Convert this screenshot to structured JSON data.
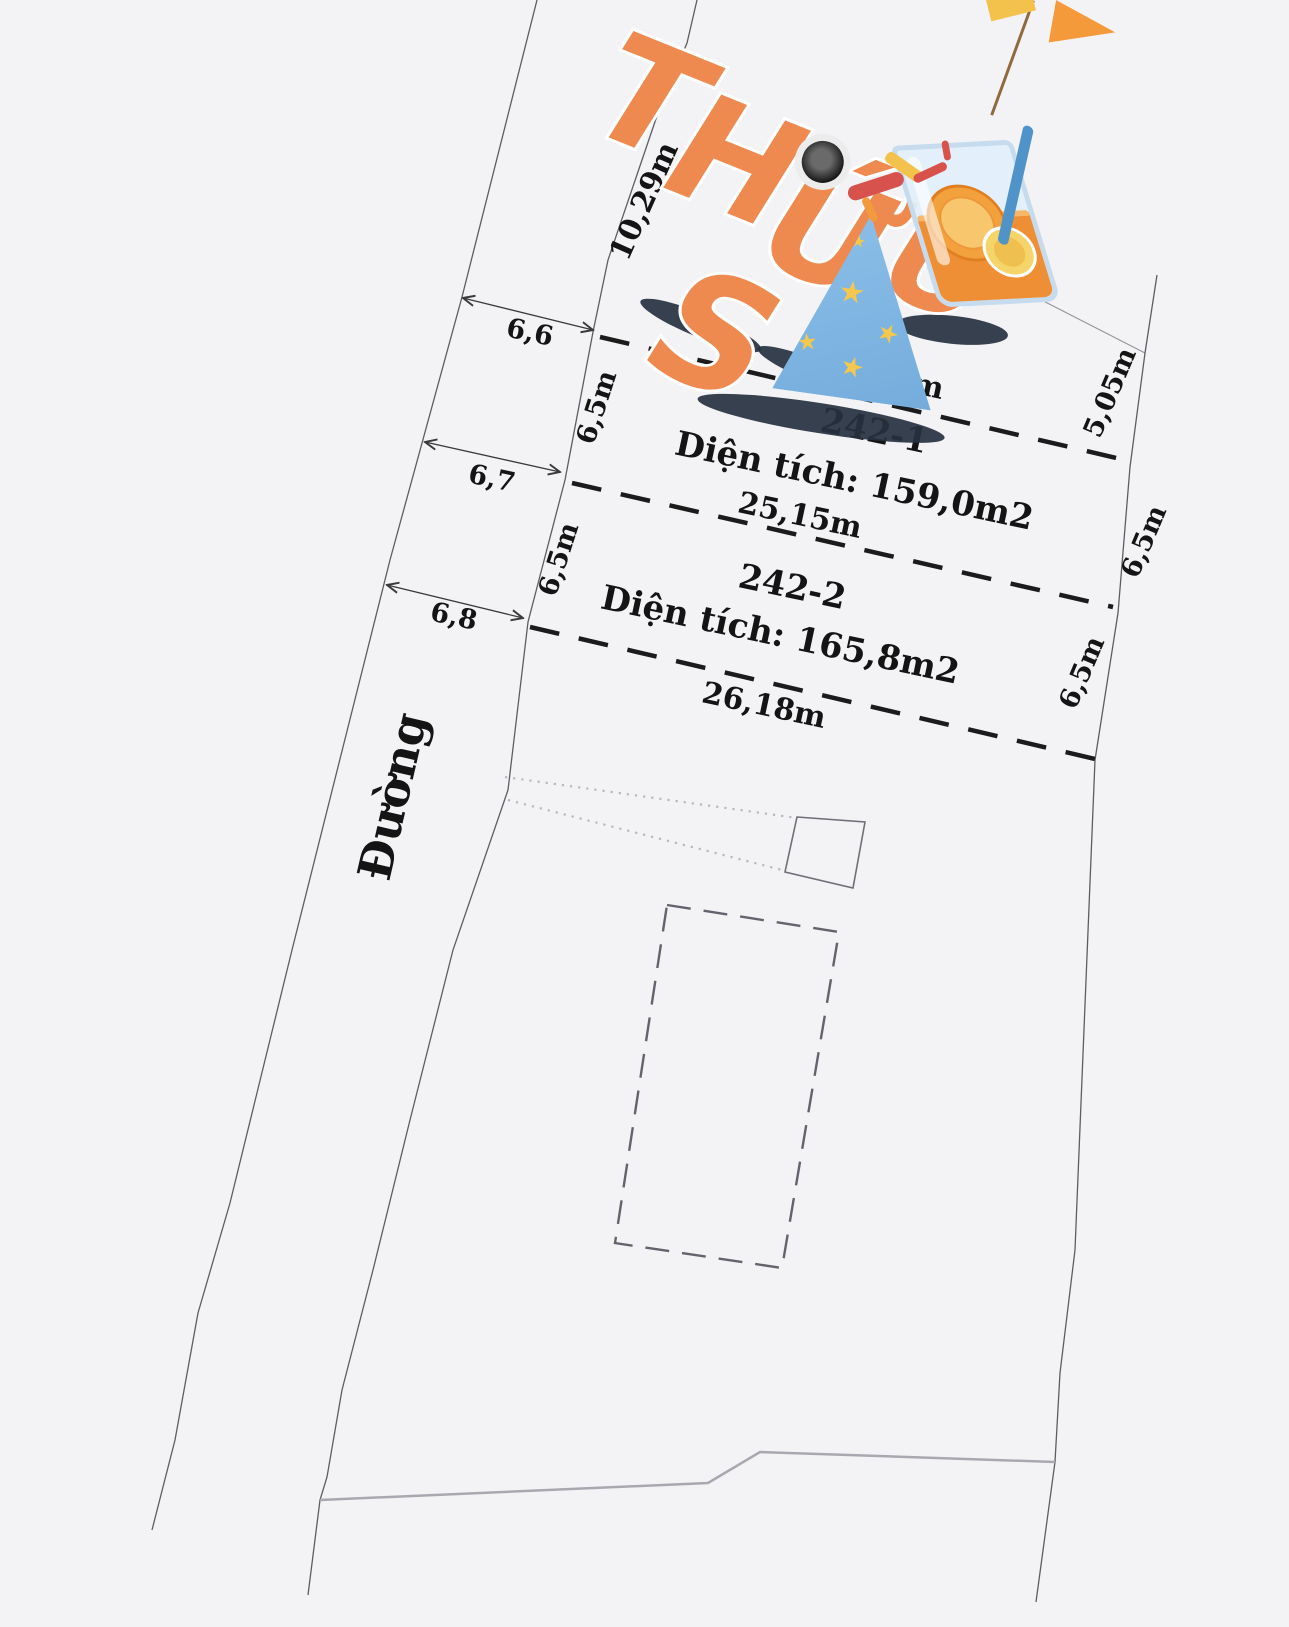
{
  "banner": {
    "letters_top": [
      "T",
      "H",
      "Ứ"
    ],
    "letter_s": "S",
    "letter_u": "U",
    "word_full": "THỨ SÁU"
  },
  "road": {
    "name": "Đường"
  },
  "parcels": [
    {
      "id": "242-1",
      "area": "Diện tích: 159,0m2"
    },
    {
      "id": "242-2",
      "area": "Diện tích: 165,8m2"
    }
  ],
  "dimensions": {
    "top_boundary": "10,29m",
    "road_width_top": "6,6",
    "road_width_mid": "6,7",
    "road_width_bottom": "6,8",
    "west_depth_1": "6,5m",
    "west_depth_2": "6,5m",
    "east_top": "5,05m",
    "east_depth_1": "6,5m",
    "east_depth_2": "6,5m",
    "edge_1": "24,11m",
    "edge_2": "25,15m",
    "edge_3": "26,18m"
  },
  "colors": {
    "background": "#f3f3f6",
    "boundary_line": "#5c5c63",
    "divider_dash": "#1b1b1b",
    "south_boundary_gray": "#a8a8b0",
    "footprint_dash": "#63636d",
    "letter_orange": "#ee8a50",
    "letter_blue_3d": "#3e6e94",
    "hat_blue": "#82b8e4",
    "star_yellow": "#f4c84e",
    "drink_orange": "#ef8f35",
    "straw_blue": "#4f93c8"
  }
}
